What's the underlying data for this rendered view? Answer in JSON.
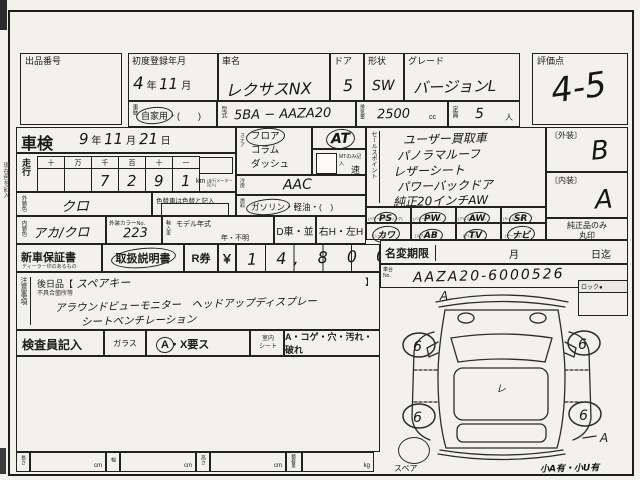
{
  "top": {
    "auction_no": {
      "label": "出品番号"
    },
    "first_reg": {
      "label": "初度登録年月",
      "d1": "4",
      "u1": "年",
      "d2": "11",
      "u2": "月"
    },
    "car_name": {
      "label": "車名",
      "value": "レクサスNX"
    },
    "door": {
      "label": "ドア",
      "value": "5"
    },
    "shape": {
      "label": "形状",
      "value": "SW"
    },
    "grade": {
      "label": "グレード",
      "value": "バージョンL"
    },
    "score": {
      "label": "評価点",
      "value": "4-5"
    }
  },
  "reg_row": {
    "history_label": "車歴",
    "history_opt": "自家用",
    "history_rest": "・(　　)",
    "model_label": "型式",
    "model_value": "5BA − AAZA20",
    "disp_label": "排気量",
    "disp_value": "2500",
    "disp_unit": "cc",
    "cap_label": "定員",
    "cap_value": "5",
    "cap_unit": "人"
  },
  "shaken": {
    "label": "車検",
    "d1": "9",
    "u1": "年",
    "d2": "11",
    "u2": "月",
    "d3": "21",
    "u3": "日"
  },
  "mileage": {
    "label": "走行",
    "headers": [
      "十",
      "万",
      "千",
      "百",
      "十",
      "一"
    ],
    "digits": [
      "",
      "",
      "7",
      "2",
      "9",
      "1"
    ],
    "unit": "km",
    "note": "(走行メーター記入)"
  },
  "ext_color": {
    "label": "外装色",
    "value": "クロ",
    "note": "色替車は色替と記入"
  },
  "int_color": {
    "label": "内装色",
    "value": "アカ/クロ",
    "no_label": "外装カラーNo.",
    "no_value": "223"
  },
  "steering": {
    "label": "ステア",
    "opt1": "フロア",
    "opt2": "コラム",
    "opt3": "ダッシュ",
    "at": "AT",
    "mt_note": "MTのみ記入",
    "mt_unit": "速"
  },
  "ac": {
    "label": "冷房",
    "value": "AAC"
  },
  "fuel": {
    "label": "燃料",
    "opt1": "ガソリン",
    "rest": "・軽油・(　)"
  },
  "import_row": {
    "label": "輸入車",
    "my_label": "モデル年式",
    "my_note": "年・不明",
    "d": "D車・並",
    "h": "右H・左H"
  },
  "docs": {
    "warranty": "新車保証書",
    "warranty_sub": "ディーラー印のあるもの",
    "manual": "取扱説明書",
    "ticket": "R券",
    "yen": "￥",
    "amount": "1 4, 8 0 0"
  },
  "sales": {
    "label": "セールスポイント",
    "lines": [
      "ユーザー買取車",
      "パノラマルーフ",
      "レザーシート",
      "パワーバックドア",
      "純正20インチAW"
    ]
  },
  "equip": {
    "r1": [
      {
        "c": "PS",
        "s": "(パワーステアリング)"
      },
      {
        "c": "PW",
        "s": "(パワーウインド)"
      },
      {
        "c": "AW",
        "s": "(アルミホイール)"
      },
      {
        "c": "SR",
        "s": "(サンルーフ)"
      }
    ],
    "r2": [
      {
        "c": "カワ",
        "s": "(シート)"
      },
      {
        "c": "AB",
        "s": "(エアバッグ)"
      },
      {
        "c": "TV",
        "s": "(テレビ)"
      },
      {
        "c": "ナビ",
        "s": "(ゲーション)"
      }
    ]
  },
  "grades": {
    "ext_label": "〔外装〕",
    "ext_value": "B",
    "int_label": "〔内装〕",
    "int_value": "A",
    "note1": "純正品のみ",
    "note2": "丸印"
  },
  "name_change": {
    "label": "名変期限",
    "month": "月",
    "day": "日迄"
  },
  "chassis": {
    "label": "車台",
    "label2": "No.",
    "value": "AAZA20-6000526"
  },
  "notes": {
    "label": "注意事項",
    "later": "後日品【",
    "later_value": "スペアキー",
    "close": "】",
    "defect": "不具合箇所等",
    "line1": "アラウンドビューモニター　ヘッドアップディスプレー",
    "line2": "シートベンチレーション"
  },
  "inspector": {
    "label": "検査員記入",
    "glass": "ガラス",
    "glass_a": "A",
    "glass_rest": "・X要ス",
    "seat1": "室内",
    "seat2": "シート",
    "seat_note": "A・コゲ・穴・汚れ・破れ"
  },
  "dims": {
    "l": "長さ",
    "w": "幅",
    "h": "高さ",
    "load": "積載量",
    "cm": "cm",
    "kg": "kg"
  },
  "diagram": {
    "lock": "ロック●",
    "spare": "スペア",
    "note": "小A有・小U有",
    "w1": "6",
    "w2": "6",
    "w3": "6",
    "w4": "6",
    "front": "A",
    "rear": "A",
    "center": "レ"
  },
  "edge_note": "現在色を記入"
}
